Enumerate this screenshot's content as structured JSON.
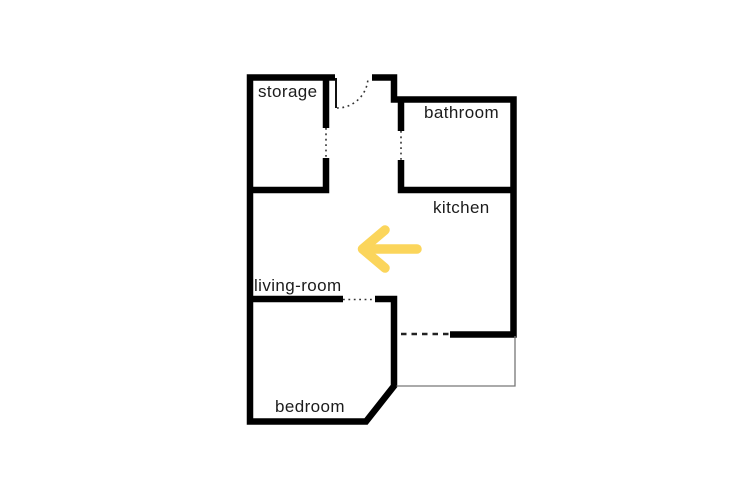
{
  "app": {
    "type": "apartment-floor-plan",
    "background_color": "#ffffff"
  },
  "floor_plan": {
    "wall_color": "#000000",
    "door_line_color": "#333333",
    "balcony_line_color": "#777777",
    "label_color": "#1c1c1c",
    "rooms": [
      {
        "id": "storage",
        "label": "storage"
      },
      {
        "id": "bathroom",
        "label": "bathroom"
      },
      {
        "id": "kitchen",
        "label": "kitchen"
      },
      {
        "id": "living-room",
        "label": "living-room"
      },
      {
        "id": "bedroom",
        "label": "bedroom"
      }
    ],
    "arrow": {
      "direction": "left",
      "color": "#FBD55B"
    }
  }
}
